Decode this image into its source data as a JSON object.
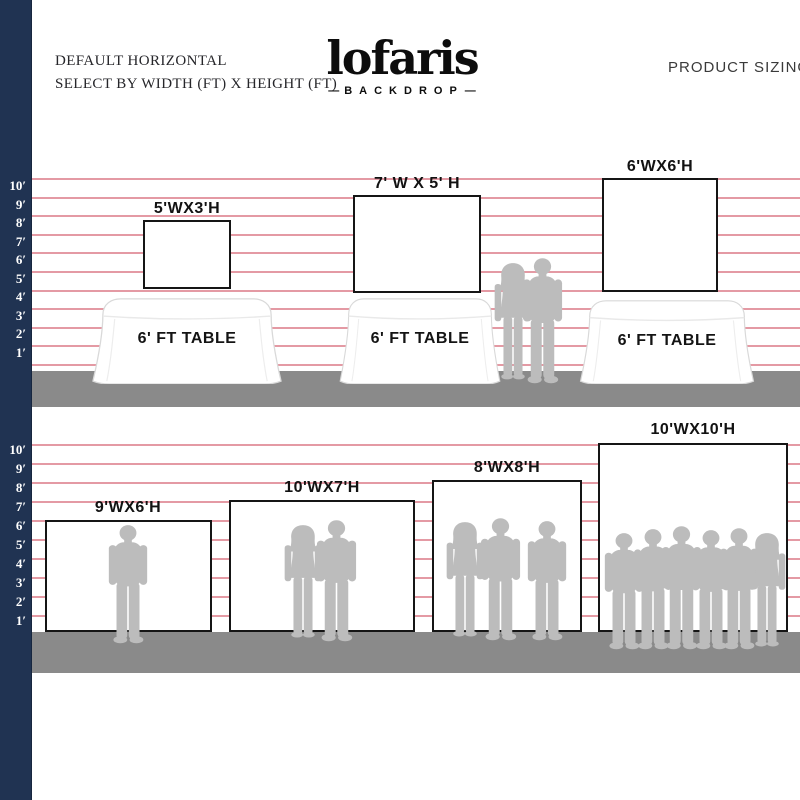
{
  "header": {
    "line1": "DEFAULT HORIZONTAL",
    "line2": "SELECT BY WIDTH (FT) X HEIGHT (FT)",
    "logo": "lofaris",
    "logo_sub": "BACKDROP",
    "dash": "—",
    "right_title": "PRODUCT SIZING"
  },
  "ruler": [
    "10′",
    "9′",
    "8′",
    "7′",
    "6′",
    "5′",
    "4′",
    "3′",
    "2′",
    "1′"
  ],
  "tables": {
    "label": "6' FT TABLE"
  },
  "backdrops": {
    "tabletop": [
      {
        "size": "5'WX3'H",
        "width_ft": 5,
        "height_ft": 3
      },
      {
        "size": "7' W X 5' H",
        "width_ft": 7,
        "height_ft": 5
      },
      {
        "size": "6'WX6'H",
        "width_ft": 6,
        "height_ft": 6
      }
    ],
    "floor": [
      {
        "size": "9'WX6'H",
        "width_ft": 9,
        "height_ft": 6
      },
      {
        "size": "10'WX7'H",
        "width_ft": 10,
        "height_ft": 7
      },
      {
        "size": "8'WX8'H",
        "width_ft": 8,
        "height_ft": 8
      },
      {
        "size": "10'WX10'H",
        "width_ft": 10,
        "height_ft": 10
      }
    ]
  },
  "colors": {
    "navy_strip": "#203352",
    "gridline_pink": "#e49aa4",
    "floor_gray": "#8a8a8a",
    "silhouette_gray": "#bcbcbc",
    "backdrop_border": "#151515"
  }
}
